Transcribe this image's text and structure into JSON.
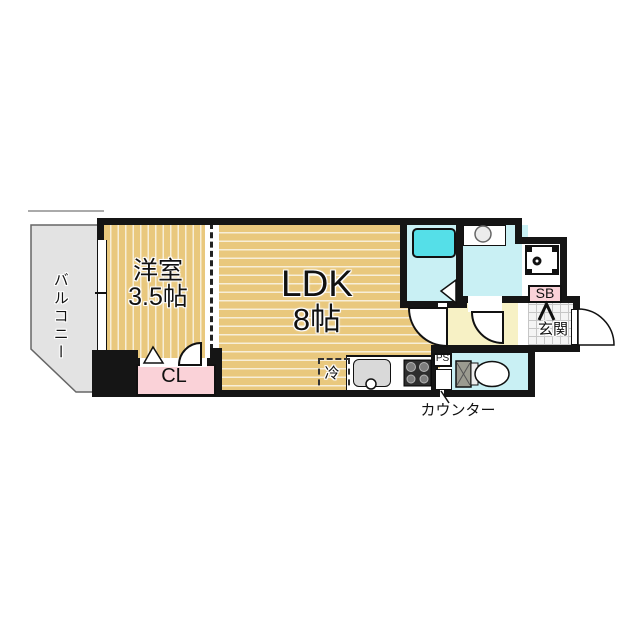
{
  "plan": {
    "type": "apartment-floor-plan-1ldk",
    "labels": {
      "balcony": "バルコニー",
      "western_room_name": "洋室",
      "western_room_size": "3.5帖",
      "ldk_name": "LDK",
      "ldk_size": "8帖",
      "closet": "CL",
      "refrigerator": "冷",
      "shoe_box": "SB",
      "entrance": "玄関",
      "pipe_space": "PS",
      "counter": "カウンター"
    },
    "colors": {
      "wall": "#151515",
      "flooring_tan": "#e9c87d",
      "flooring_line": "#f7eed8",
      "balcony_gray": "#e3e3e3",
      "wet_area_cyan": "#c9f0f4",
      "bathtub_cyan": "#55dfe8",
      "closet_pink": "#fad2d8",
      "hall_yellow": "#f7f1c5",
      "entrance_tile": "#f4f4f4"
    }
  }
}
